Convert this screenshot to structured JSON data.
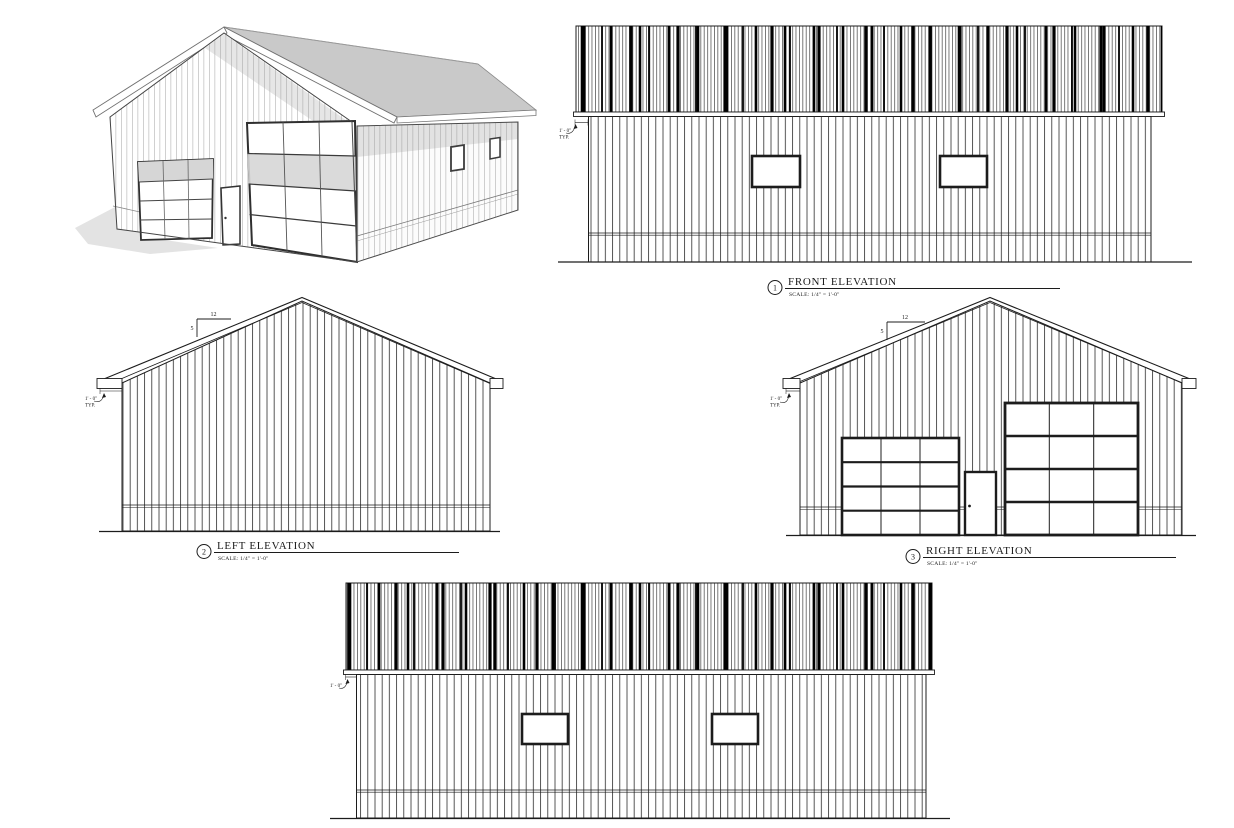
{
  "colors": {
    "ink": "#1c1c1c",
    "roof_gray": "#c9c9c9",
    "shadow_gray": "#e3e3e3",
    "door_glass_gray": "#d6d6d6"
  },
  "views": {
    "front": {
      "number": "1",
      "title": "FRONT ELEVATION",
      "scale": "SCALE:  1/4\" = 1'-0\"",
      "eave_note_dim": "1' - 0\"",
      "eave_note_typ": "TYP."
    },
    "left": {
      "number": "2",
      "title": "LEFT ELEVATION",
      "scale": "SCALE:  1/4\" = 1'-0\"",
      "eave_note_dim": "1' - 0\"",
      "eave_note_typ": "TYP.",
      "slope_run": "12",
      "slope_rise": "5"
    },
    "right": {
      "number": "3",
      "title": "RIGHT ELEVATION",
      "scale": "SCALE:  1/4\" = 1'-0\"",
      "eave_note_dim": "1' - 0\"",
      "eave_note_typ": "TYP.",
      "slope_run": "12",
      "slope_rise": "5"
    },
    "rear": {
      "eave_note_dim": "1' - 0\""
    }
  }
}
